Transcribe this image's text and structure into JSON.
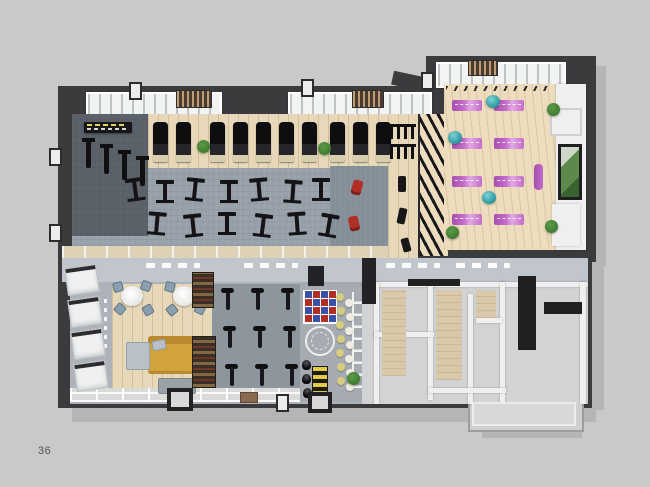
{
  "page": {
    "number": "36"
  },
  "palette": {
    "bg": "#c9c9c9",
    "shadow": "#b5b5b6",
    "wallDark": "#3b3b3e",
    "wallDark2": "#28282b",
    "band": "#c1c6cc",
    "carpet": "#98a1aa",
    "carpetDark": "#858f98",
    "spinCarpet": "#8d959d",
    "functFloor": "#a5abb1",
    "wood": "#e6d8b8",
    "woodLight": "#edddbe",
    "walkway": "#ded2b6",
    "matA": "#c36cc9",
    "matB": "#a74fb2",
    "matLight": "#e3a8e3",
    "ball": "#2f9aa3",
    "sofa": "#d2a23b",
    "sofaDark": "#b98a2e",
    "cushion": "#b9c1c8",
    "red": "#b03028",
    "blue": "#3a52a5",
    "dotYellow": "#d6cd7e",
    "dotWhite": "#efede2",
    "green": "#3f7b31",
    "greenLight": "#5c9b47",
    "lockerFloor": "#d2d3d4",
    "lockerWall": "#efefef",
    "beige": "#d8c9ab",
    "dark": "#202023"
  },
  "scene": {
    "items": [
      {
        "t": "treadmill",
        "x": 153,
        "y": 122
      },
      {
        "t": "treadmill",
        "x": 176,
        "y": 122
      },
      {
        "t": "treadmill",
        "x": 210,
        "y": 122
      },
      {
        "t": "treadmill",
        "x": 233,
        "y": 122
      },
      {
        "t": "treadmill",
        "x": 256,
        "y": 122
      },
      {
        "t": "treadmill",
        "x": 279,
        "y": 122
      },
      {
        "t": "treadmill",
        "x": 302,
        "y": 122
      },
      {
        "t": "treadmill",
        "x": 330,
        "y": 122
      },
      {
        "t": "treadmill",
        "x": 353,
        "y": 122
      },
      {
        "t": "treadmill",
        "x": 376,
        "y": 122
      },
      {
        "t": "plant",
        "x": 197,
        "y": 140
      },
      {
        "t": "plant",
        "x": 318,
        "y": 142
      },
      {
        "t": "machine",
        "x": 126,
        "y": 176,
        "r": -8
      },
      {
        "t": "machine",
        "x": 156,
        "y": 178
      },
      {
        "t": "machine",
        "x": 186,
        "y": 176,
        "r": 6
      },
      {
        "t": "machine",
        "x": 220,
        "y": 178
      },
      {
        "t": "machine",
        "x": 250,
        "y": 176,
        "r": -5
      },
      {
        "t": "machine",
        "x": 284,
        "y": 178,
        "r": 4
      },
      {
        "t": "machine",
        "x": 312,
        "y": 176
      },
      {
        "t": "machine",
        "x": 148,
        "y": 210,
        "r": 5
      },
      {
        "t": "machine",
        "x": 184,
        "y": 212,
        "r": -6
      },
      {
        "t": "machine",
        "x": 218,
        "y": 210
      },
      {
        "t": "machine",
        "x": 254,
        "y": 212,
        "r": 7
      },
      {
        "t": "machine",
        "x": 288,
        "y": 210,
        "r": -4
      },
      {
        "t": "machine",
        "x": 320,
        "y": 212,
        "r": 10
      },
      {
        "t": "machine-upright",
        "x": 86,
        "y": 138
      },
      {
        "t": "machine-upright",
        "x": 104,
        "y": 144
      },
      {
        "t": "machine-upright",
        "x": 122,
        "y": 150
      },
      {
        "t": "machine-upright",
        "x": 140,
        "y": 156
      },
      {
        "t": "rack",
        "x": 390,
        "y": 124,
        "w": 26,
        "h": 12
      },
      {
        "t": "rack",
        "x": 390,
        "y": 144,
        "w": 26,
        "h": 12
      },
      {
        "t": "bench",
        "x": 398,
        "y": 176,
        "w": 8,
        "h": 16
      },
      {
        "t": "bench",
        "x": 398,
        "y": 208,
        "w": 8,
        "h": 16,
        "r": 12
      },
      {
        "t": "bench",
        "x": 402,
        "y": 238,
        "w": 8,
        "h": 14,
        "r": -15
      },
      {
        "t": "red-mat",
        "x": 352,
        "y": 180,
        "w": 10,
        "h": 15,
        "r": 15
      },
      {
        "t": "red-mat",
        "x": 349,
        "y": 216,
        "w": 10,
        "h": 15,
        "r": -12
      },
      {
        "t": "yoga-mat",
        "x": 452,
        "y": 100
      },
      {
        "t": "yoga-mat",
        "x": 494,
        "y": 100
      },
      {
        "t": "yoga-mat",
        "x": 452,
        "y": 138
      },
      {
        "t": "yoga-mat",
        "x": 494,
        "y": 138
      },
      {
        "t": "yoga-mat",
        "x": 452,
        "y": 176
      },
      {
        "t": "yoga-mat",
        "x": 494,
        "y": 176
      },
      {
        "t": "yoga-mat",
        "x": 452,
        "y": 214
      },
      {
        "t": "yoga-mat",
        "x": 494,
        "y": 214
      },
      {
        "t": "mat-roll",
        "x": 534,
        "y": 164,
        "w": 9,
        "h": 26
      },
      {
        "t": "exercise-ball",
        "x": 486,
        "y": 95
      },
      {
        "t": "exercise-ball",
        "x": 448,
        "y": 131
      },
      {
        "t": "exercise-ball",
        "x": 482,
        "y": 191
      },
      {
        "t": "plant",
        "x": 547,
        "y": 103
      },
      {
        "t": "plant",
        "x": 545,
        "y": 220
      },
      {
        "t": "plant",
        "x": 446,
        "y": 226
      },
      {
        "t": "cafe-table",
        "x": 121,
        "y": 286
      },
      {
        "t": "cafe-table",
        "x": 173,
        "y": 286
      },
      {
        "t": "chair",
        "x": 113,
        "y": 282,
        "r": -15
      },
      {
        "t": "chair",
        "x": 141,
        "y": 281,
        "r": 20
      },
      {
        "t": "chair",
        "x": 115,
        "y": 304,
        "r": 40
      },
      {
        "t": "chair",
        "x": 143,
        "y": 305,
        "r": -30
      },
      {
        "t": "chair",
        "x": 165,
        "y": 282,
        "r": 15
      },
      {
        "t": "chair",
        "x": 193,
        "y": 281,
        "r": -20
      },
      {
        "t": "chair",
        "x": 167,
        "y": 305,
        "r": -40
      },
      {
        "t": "chair",
        "x": 195,
        "y": 304,
        "r": 25
      },
      {
        "t": "bookshelf",
        "x": 192,
        "y": 272,
        "w": 20,
        "h": 34
      },
      {
        "t": "bookshelf",
        "x": 192,
        "y": 336,
        "w": 22,
        "h": 50
      },
      {
        "t": "shelf-unit",
        "x": 66,
        "y": 266,
        "r": -8
      },
      {
        "t": "shelf-unit",
        "x": 69,
        "y": 298,
        "r": -8
      },
      {
        "t": "shelf-unit",
        "x": 72,
        "y": 330,
        "r": -8
      },
      {
        "t": "shelf-unit",
        "x": 75,
        "y": 362,
        "r": -8
      },
      {
        "t": "spin-bike",
        "x": 220,
        "y": 288
      },
      {
        "t": "spin-bike",
        "x": 250,
        "y": 288
      },
      {
        "t": "spin-bike",
        "x": 280,
        "y": 288
      },
      {
        "t": "spin-bike",
        "x": 222,
        "y": 326
      },
      {
        "t": "spin-bike",
        "x": 252,
        "y": 326
      },
      {
        "t": "spin-bike",
        "x": 282,
        "y": 326
      },
      {
        "t": "spin-bike",
        "x": 224,
        "y": 364
      },
      {
        "t": "spin-bike",
        "x": 254,
        "y": 364
      },
      {
        "t": "spin-bike",
        "x": 284,
        "y": 364
      },
      {
        "t": "floor-dot",
        "x": 336,
        "y": 293,
        "c": "#d6cd7e"
      },
      {
        "t": "floor-dot",
        "x": 345,
        "y": 299,
        "c": "#efede2"
      },
      {
        "t": "floor-dot",
        "x": 337,
        "y": 307,
        "c": "#d6cd7e"
      },
      {
        "t": "floor-dot",
        "x": 346,
        "y": 313,
        "c": "#efede2"
      },
      {
        "t": "floor-dot",
        "x": 336,
        "y": 321,
        "c": "#d6cd7e"
      },
      {
        "t": "floor-dot",
        "x": 345,
        "y": 327,
        "c": "#efede2"
      },
      {
        "t": "floor-dot",
        "x": 337,
        "y": 335,
        "c": "#d6cd7e"
      },
      {
        "t": "floor-dot",
        "x": 346,
        "y": 341,
        "c": "#efede2"
      },
      {
        "t": "floor-dot",
        "x": 336,
        "y": 349,
        "c": "#d6cd7e"
      },
      {
        "t": "floor-dot",
        "x": 345,
        "y": 355,
        "c": "#efede2"
      },
      {
        "t": "floor-dot",
        "x": 337,
        "y": 363,
        "c": "#d6cd7e"
      },
      {
        "t": "floor-dot",
        "x": 346,
        "y": 369,
        "c": "#efede2"
      },
      {
        "t": "floor-dot",
        "x": 337,
        "y": 377,
        "c": "#d6cd7e"
      },
      {
        "t": "floor-dot",
        "x": 346,
        "y": 383,
        "c": "#efede2"
      },
      {
        "t": "kettlebell",
        "x": 302,
        "y": 360
      },
      {
        "t": "kettlebell",
        "x": 302,
        "y": 374
      },
      {
        "t": "kettlebell",
        "x": 303,
        "y": 388
      },
      {
        "t": "kb-rack",
        "x": 312,
        "y": 366,
        "w": 14,
        "h": 28
      },
      {
        "t": "doormat",
        "x": 240,
        "y": 392,
        "w": 16,
        "h": 9
      },
      {
        "t": "plant",
        "x": 347,
        "y": 372
      },
      {
        "t": "sign-dashes",
        "x": 146,
        "y": 263
      },
      {
        "t": "sign-dashes",
        "x": 244,
        "y": 263
      },
      {
        "t": "sign-dashes",
        "x": 386,
        "y": 263
      },
      {
        "t": "sign-dashes",
        "x": 456,
        "y": 263
      },
      {
        "t": "sign-small",
        "x": 84,
        "y": 122
      },
      {
        "t": "pilaster",
        "x": 49,
        "y": 148
      },
      {
        "t": "pilaster",
        "x": 49,
        "y": 224
      },
      {
        "t": "pilaster",
        "x": 129,
        "y": 82
      },
      {
        "t": "pilaster",
        "x": 301,
        "y": 79
      },
      {
        "t": "pilaster",
        "x": 421,
        "y": 72
      },
      {
        "t": "pilaster",
        "x": 276,
        "y": 394
      },
      {
        "t": "door",
        "x": 167,
        "y": 388,
        "w": 18,
        "h": 15
      },
      {
        "t": "door",
        "x": 308,
        "y": 392,
        "w": 16,
        "h": 13
      },
      {
        "t": "dark-block",
        "x": 308,
        "y": 266,
        "w": 16,
        "h": 20
      },
      {
        "t": "dark-block",
        "x": 362,
        "y": 258,
        "w": 14,
        "h": 46
      }
    ]
  }
}
